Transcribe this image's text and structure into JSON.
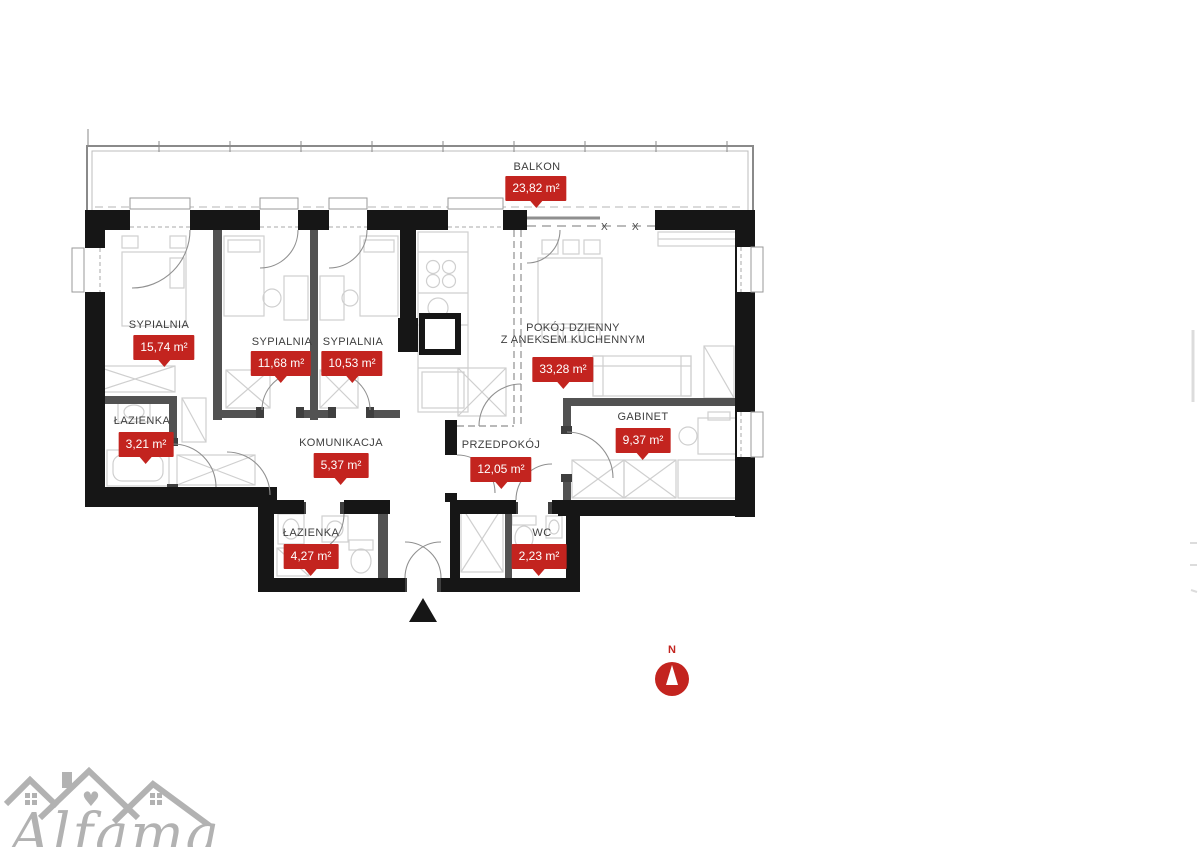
{
  "floorplan": {
    "rooms": [
      {
        "id": "balkon",
        "name": "BALKON",
        "area": "23,82 m²"
      },
      {
        "id": "sypialnia-1",
        "name": "SYPIALNIA",
        "area": "15,74 m²"
      },
      {
        "id": "sypialnia-2",
        "name": "SYPIALNIA",
        "area": "11,68 m²"
      },
      {
        "id": "sypialnia-3",
        "name": "SYPIALNIA",
        "area": "10,53 m²"
      },
      {
        "id": "lazienka-1",
        "name": "ŁAZIENKA",
        "area": "3,21 m²"
      },
      {
        "id": "komunikacja",
        "name": "KOMUNIKACJA",
        "area": "5,37 m²"
      },
      {
        "id": "przedpokoj",
        "name": "PRZEDPOKÓJ",
        "area": "12,05 m²"
      },
      {
        "id": "pokoj-dzienny",
        "name": "POKÓJ DZIENNY\nZ ANEKSEM KUCHENNYM",
        "area": "33,28 m²"
      },
      {
        "id": "gabinet",
        "name": "GABINET",
        "area": "9,37 m²"
      },
      {
        "id": "lazienka-2",
        "name": "ŁAZIENKA",
        "area": "4,27 m²"
      },
      {
        "id": "wc",
        "name": "WC",
        "area": "2,23 m²"
      }
    ],
    "compass": {
      "label": "N"
    },
    "logo": {
      "brand": "Alfama"
    },
    "glazing_marks": "X  X",
    "colors": {
      "badge": "#c3241f",
      "wall": "#161616",
      "partition": "#525252",
      "furniture": "#cfcfcf",
      "logo_gray": "#b2b2b2"
    }
  }
}
